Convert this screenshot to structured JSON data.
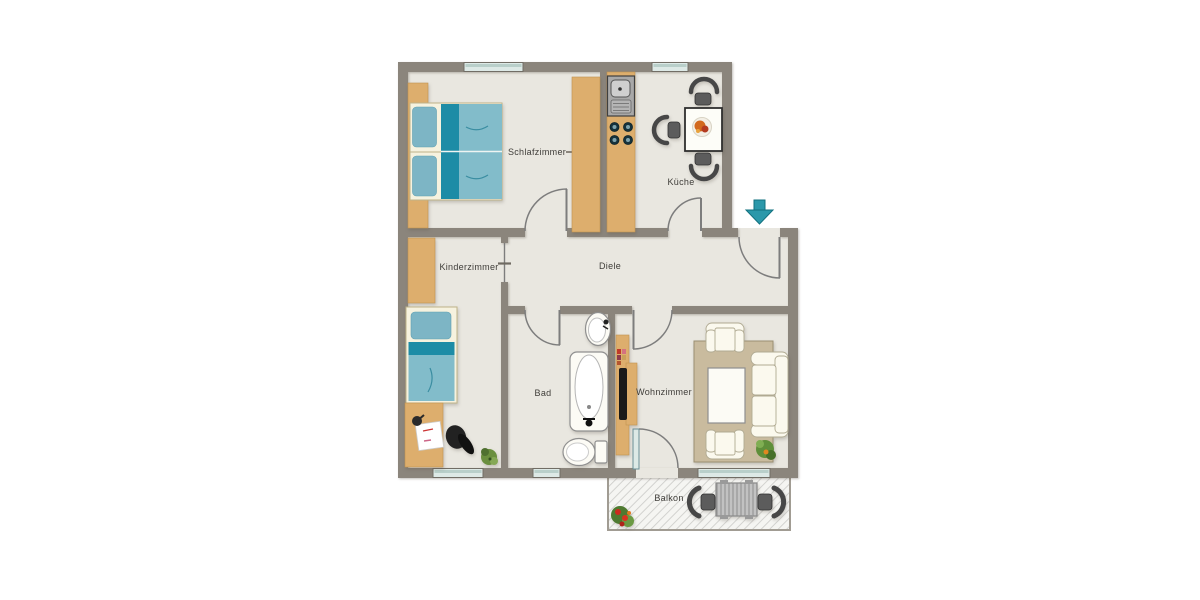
{
  "floor_plan": {
    "rooms": {
      "schlafzimmer": {
        "label": "Schlafzimmer"
      },
      "kueche": {
        "label": "Küche"
      },
      "kinderzimmer": {
        "label": "Kinderzimmer"
      },
      "diele": {
        "label": "Diele"
      },
      "bad": {
        "label": "Bad"
      },
      "wohnzimmer": {
        "label": "Wohnzimmer"
      },
      "balkon": {
        "label": "Balkon"
      }
    },
    "icons": {
      "entrance_arrow": {
        "name": "entrance-arrow-icon",
        "meaning": "entrance",
        "direction": "down"
      }
    },
    "colors": {
      "wall": "#8b857c",
      "floor": "#e9e7e0",
      "wood": "#ddae6d",
      "teal_dark": "#1d8ca6",
      "teal_light": "#82bcca",
      "pillow_blue": "#7db5c5",
      "entrance_arrow": "#2b98aa",
      "furniture_white": "#f6f2df",
      "rug": "#c9bb9e",
      "window_glass": "#dde9e6"
    }
  }
}
